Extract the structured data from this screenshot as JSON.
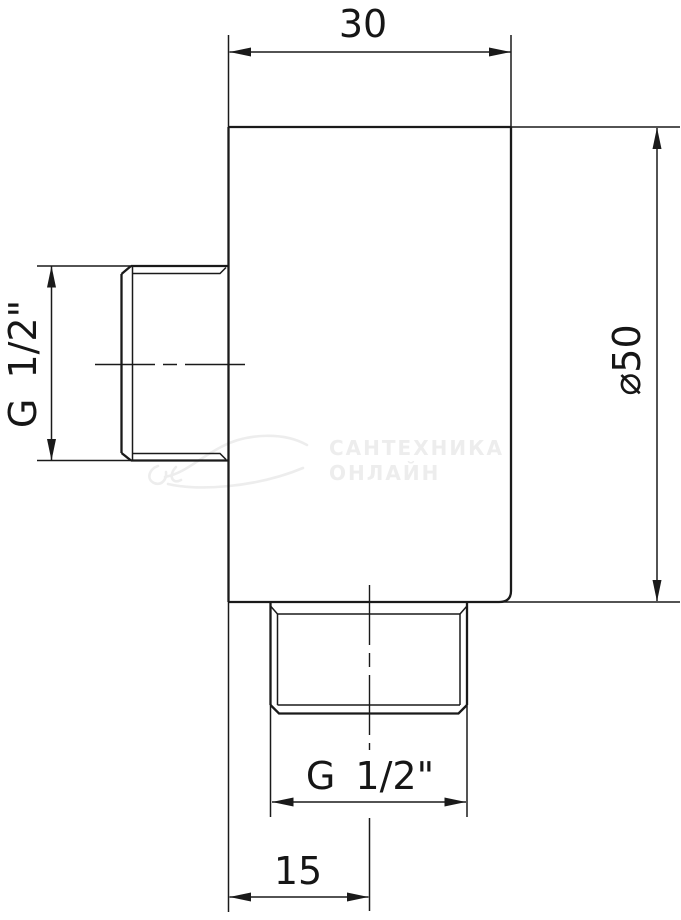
{
  "dimensions": {
    "top_width": "30",
    "body_height": "⌀50",
    "left_thread": "G 1/2\"",
    "bottom_thread": "G 1/2\"",
    "bottom_offset": "15"
  },
  "watermark": {
    "line1": "САНТЕХНИКА",
    "line2": "ОНЛАЙН"
  },
  "colors": {
    "line": "#1a1a1a",
    "background": "#ffffff",
    "watermark": "#ededed"
  }
}
